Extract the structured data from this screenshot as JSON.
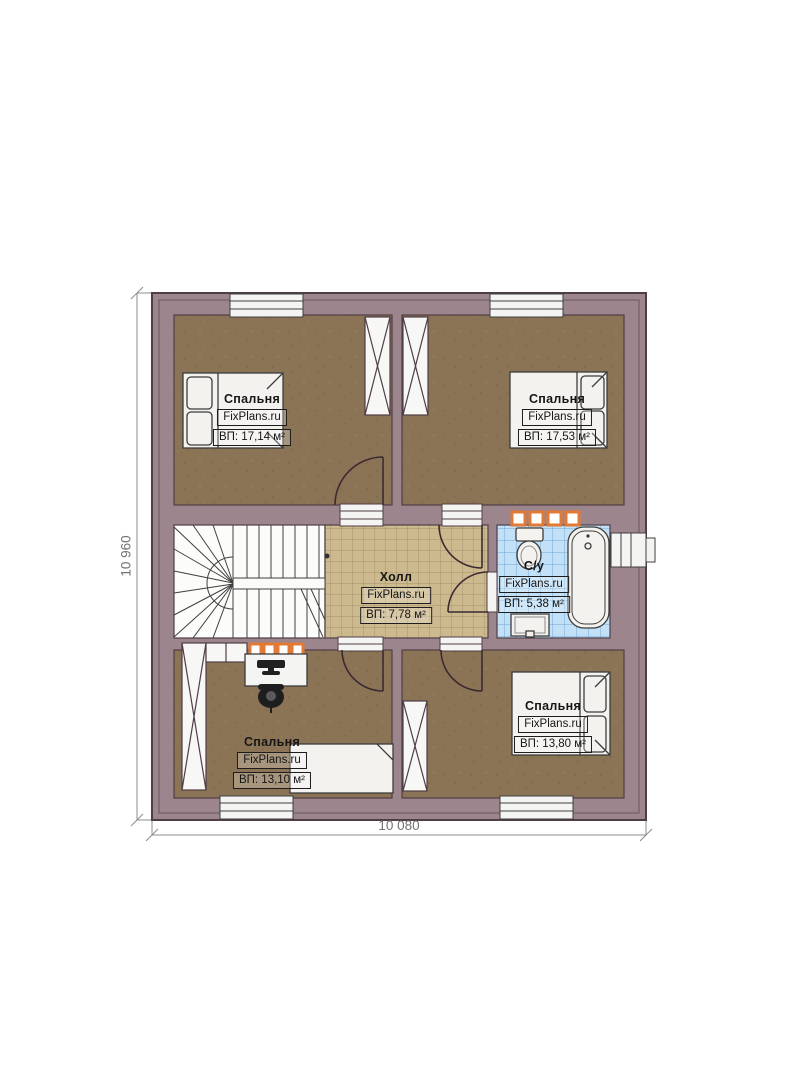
{
  "plan": {
    "rooms": [
      {
        "id": "bedroom-top-left",
        "name": "Спальня",
        "brand": "FixPlans.ru",
        "area": "ВП: 17,14 м²"
      },
      {
        "id": "bedroom-top-right",
        "name": "Спальня",
        "brand": "FixPlans.ru",
        "area": "ВП: 17,53 м²"
      },
      {
        "id": "hall",
        "name": "Холл",
        "brand": "FixPlans.ru",
        "area": "ВП: 7,78 м²"
      },
      {
        "id": "bathroom",
        "name": "С/у",
        "brand": "FixPlans.ru",
        "area": "ВП: 5,38 м²"
      },
      {
        "id": "bedroom-bottom-left",
        "name": "Спальня",
        "brand": "FixPlans.ru",
        "area": "ВП: 13,10 м²"
      },
      {
        "id": "bedroom-bottom-right",
        "name": "Спальня",
        "brand": "FixPlans.ru",
        "area": "ВП: 13,80 м²"
      }
    ],
    "dimensions": {
      "width": "10 080",
      "height": "10 960"
    },
    "colors": {
      "wall": "#9c858c",
      "wall_line": "#4f3e46",
      "bedroom_floor": "#8b7355",
      "hall_tile": "#cdb98e",
      "bath_tile": "#c2e0f6",
      "fixture": "#f3f2ef",
      "radiator": "#e27a35"
    }
  }
}
